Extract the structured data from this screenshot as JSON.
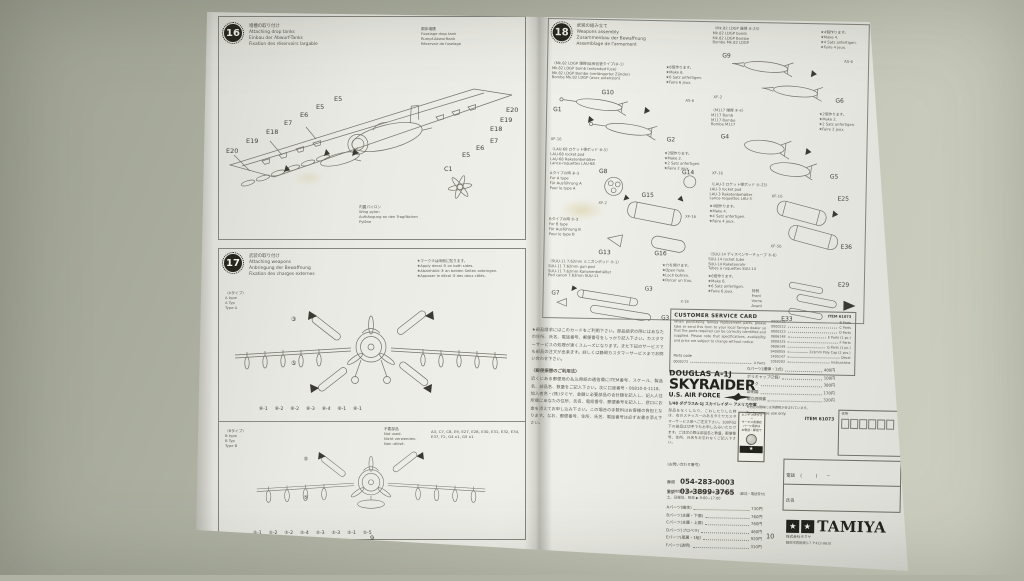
{
  "page9": {
    "page_number": "9",
    "step16": {
      "badge": "16",
      "title": [
        "増槽の取り付け",
        "Attaching drop tanks",
        "Einbau der Abwurf-Tanks",
        "Fixation des réservoirs largable"
      ],
      "fuselage_note": [
        "胴体増槽",
        "Fuselage drop tank",
        "Rumpf-Abwurftank",
        "Réservoir de fuselage"
      ],
      "pylon_note": [
        "内翼パイロン",
        "Wing pylon",
        "Aufhängung an den Tragflächen",
        "Pylône"
      ],
      "labels": {
        "l1": "E20",
        "l2": "E19",
        "l3": "E18",
        "l4": "E7",
        "l5": "E6",
        "l6": "E5",
        "l7": "E5",
        "c": "C1",
        "r1": "E5",
        "r2": "E6",
        "r3": "E7",
        "r4": "E18",
        "r5": "E19",
        "r6": "E20"
      }
    },
    "step17": {
      "badge": "17",
      "title": [
        "武装の取り付け",
        "Attaching weapons",
        "Anbringung der Bewaffnung",
        "Fixation des charges externes"
      ],
      "type_a": [
        "〈Aタイプ〉",
        "A type",
        "A Typ",
        "Type A"
      ],
      "decal_note": [
        "★マーク③は両側に貼ります。",
        "★Apply decal ③ on both sides.",
        "★Abziehbild ③ an beiden Seiten anbringen.",
        "★Apposer le décal ③ des deux côtés."
      ],
      "marks_a": {
        "m1": "③",
        "m2": "⑤"
      },
      "marks_b": {
        "m1": "⑤",
        "m2": "⑤"
      },
      "row_a": [
        "⑧-1",
        "⑧-2",
        "⑧-2",
        "⑧-3",
        "⑧-4",
        "⑧-1",
        "⑧-1"
      ],
      "type_b": [
        "〈Bタイプ〉",
        "B type",
        "B Typ",
        "Type B"
      ],
      "not_used": [
        "不要部品",
        "Not used.",
        "Nicht verwenden.",
        "Non utilisé."
      ],
      "not_used_parts": "A3, C7, C8, E9, E27, E28, E30, E31, E32, E34, E37, F2, G4 x1, G5 x1",
      "row_b": [
        "⑤-1",
        "⑤-2",
        "⑤-2",
        "⑤-4",
        "⑤-3",
        "⑤-3",
        "⑤-1",
        "⑤-5"
      ]
    }
  },
  "page10": {
    "page_number": "10",
    "step18": {
      "badge": "18",
      "title": [
        "武装の組み立て",
        "Weapons assembly",
        "Zusammenbau der Bewaffnung",
        "Assemblage de l'armement"
      ],
      "mk82ext": {
        "heading": [
          "〈Mk.82 LDGP 爆弾(延長信管タイプ)⑧-1〉",
          "Mk.82 LDGP bomb (extended fuse)",
          "Mk.82 LDGP Bombe (verlängerter Zünder)",
          "Bombe Mk.82 LDGP (avec extension)"
        ],
        "notes": [
          "★6個作ります。",
          "★Make 6.",
          "★6 Satz anfertigen.",
          "★Faire 6 jeux."
        ],
        "parts": {
          "a": "G10",
          "b": "G1",
          "c": "G2"
        },
        "paints": {
          "p1": "XF-16",
          "p2": "AS-6"
        }
      },
      "mk82": {
        "heading": [
          "〈Mk.82 LDGP 爆弾 ⑧-23〉",
          "Mk.82 LDGP bomb",
          "Mk.82 LDGP Bombe",
          "Bombe Mk.82 LDGP"
        ],
        "notes": [
          "★4個作ります。",
          "★Make 4.",
          "★4 Satz anfertigen.",
          "★Faire 4 jeux."
        ],
        "parts": {
          "a": "G9",
          "b": "G6"
        },
        "paints": {
          "p1": "AS-6",
          "p2": "XF-2"
        }
      },
      "m117": {
        "heading": [
          "〈M117 爆弾 ⑨-4〉",
          "M117 Bomb",
          "M117 Bombe",
          "Bombe M117"
        ],
        "notes": [
          "★2個作ります。",
          "★Make 2.",
          "★2 Satz anfertigen.",
          "★Faire 2 jeux."
        ],
        "parts": {
          "a": "G4",
          "b": "G5"
        },
        "paints": {
          "p1": "XF-16"
        }
      },
      "lau68": {
        "heading": [
          "〈LAU-68 ロケット弾ポッド ⑧-5〉",
          "LAU-68 rocket pod",
          "LAU-68 Raketenbehälter",
          "Lance-roquettes LAU-68"
        ],
        "notes": [
          "★2個作ります。",
          "★Make 2.",
          "★2 Satz anfertigen.",
          "★Faire 2 jeux."
        ],
        "type_a": [
          "Aタイプの時 ⑧-3",
          "For A type",
          "Für Ausführung A",
          "Pour le type A"
        ],
        "type_b": [
          "Bタイプの時 ⑤-3",
          "For B type",
          "Für Ausführung B",
          "Pour le type B"
        ],
        "parts": {
          "a": "G8",
          "b": "G15",
          "c": "G13",
          "d": "G16",
          "e": "G14"
        },
        "paints": {
          "p1": "XF-2",
          "p2": "XF-16"
        }
      },
      "lau3": {
        "heading": [
          "〈LAU-3 ロケット弾ポッド ⑤-23〉",
          "LAU-3 rocket pod",
          "LAU-3 Raketenbehälter",
          "Lance-roquettes LAU-3"
        ],
        "notes": [
          "★4個作ります。",
          "★Make 4.",
          "★4 Satz anfertigen.",
          "★Faire 4 jeux."
        ],
        "parts": {
          "a": "E25",
          "b": "E36"
        },
        "paints": {
          "p1": "XF-16",
          "p2": "XF-56"
        }
      },
      "suu11": {
        "heading": [
          "〈SUU-11 7.62mm ミニガンポッド ⑤-1〉",
          "SUU-11 7.62mm gun pod",
          "SUU-11 7.62mm Kanonenbehälter",
          "Pod canon 7.62mm SUU-11"
        ],
        "notes": [
          "★穴を開けます。",
          "★Open hole.",
          "★Loch bohren.",
          "★Percer un trou."
        ],
        "parts": {
          "a": "G7",
          "b": "G3",
          "c": "G3"
        },
        "paints": {
          "p1": "X-18"
        }
      },
      "suu14": {
        "heading": [
          "〈SUU-14 ディスペンサーチューブ ⑤-6〉",
          "SUU-14 rocket tube",
          "SUU-14 Raketenrohr",
          "Tubes à roquettes SUU-14"
        ],
        "notes": [
          "★6個作ります。",
          "★Make 6.",
          "★6 Satz anfertigen.",
          "★Faire 6 jeux."
        ],
        "front": [
          "前側",
          "Front",
          "Vorne",
          "Avant"
        ],
        "parts": {
          "a": "E29",
          "b": "E33"
        }
      }
    },
    "service_text": {
      "para1": "★部品請求にはこのカードをご利用下さい。部品請求の際にはあなたの住所、氏名、電話番号、郵便番号をしっかり記入下さい。カスタマーサービスの処理が速くスムーズになります。また下記のサービスでも部品の注文が出来ます。詳しくは静岡カスタマーサービスまでお問い合わせ下さい。",
      "heading2": "〈郵便振替のご利用法〉",
      "para2": "近くにある郵便局の払込用紙の通信欄にITEM番号、スケール、製品名、部品名、数量をご記入下さい。次に口座番号・00810-0-1118、加入者名・(株)タミヤ、金額に必要部品の合計額を記入し、記入人住所欄にあなたの住所、氏名、電話番号、郵便番号を記入し、窓口にお金を添えてお申し込み下さい。この場合の手数料はお客様の負担となります。なお、郵便番号、住所、氏名、電話番号は必ずお書き添え下さい。"
    },
    "customer_card": {
      "title": "CUSTOMER SERVICE CARD",
      "body": "When purchasing Tamiya replacement parts, please take or send this form to your local Tamiya dealer so that the parts required can be correctly identified and supplied. Please note that specifications, availability and price are subject to change without notice.",
      "parts_code_label": "Parts code",
      "first_code": "0000273",
      "first_label": "A Parts",
      "item": "ITEM 61073",
      "codes": [
        {
          "c": "0000221",
          "l": "B Parts"
        },
        {
          "c": "0000222",
          "l": "C Parts"
        },
        {
          "c": "0000223",
          "l": "D Parts"
        },
        {
          "c": "0606148",
          "l": "E Parts (1 pc.)"
        },
        {
          "c": "0000225",
          "l": "F Parts"
        },
        {
          "c": "0606149",
          "l": "G Parts (1 pc.)"
        },
        {
          "c": "9400055",
          "l": "2x3mm Poly Cap (2 pcs.)"
        },
        {
          "c": "1405147",
          "l": "Decal"
        },
        {
          "c": "1050203",
          "l": "Instructions"
        }
      ]
    },
    "product": {
      "name1": "DOUGLAS A-1J",
      "name2": "SKYRAIDER",
      "name3": "U.S. AIR FORCE",
      "sub": "1/48 ダグラスA-1J スカイレイダー アメリカ空軍",
      "body": "部品をなくしたり、こわしたりした時は、右のステッカーのあるタミヤカスタマーサービス係へご注文下さい。100円以下の部品は切手でもお申し込みいただけます。ご注文の際は部品名と数量、郵便番号、住所、氏名をお忘れなくご記入下さい。",
      "inquiry": "(お問い合わせ番号)",
      "badge": [
        "タミヤ カスタマー",
        "サービス直通店",
        "パーツ請求は",
        "お電話・郵送で"
      ],
      "phone1_label": "静岡",
      "phone1": "054-283-0003",
      "phone2_label": "東京",
      "phone2": "03-3899-3765",
      "phone2_note": "(郵送・電話受付)",
      "hours1": "受付時間/平日(月~金曜日)▶ 9:00~12:00",
      "hours2": "土、日曜日、祝日 ▶ 9:00~17:00",
      "prices_left": [
        {
          "l": "Aパーツ(機体)",
          "v": "730円"
        },
        {
          "l": "Bパーツ(主翼・下面)",
          "v": "760円"
        },
        {
          "l": "Cパーツ(主翼・上面)",
          "v": "760円"
        },
        {
          "l": "Dパーツ(プロペラ)",
          "v": "460円"
        },
        {
          "l": "Eパーツ(尾翼・1組)",
          "v": "920円"
        },
        {
          "l": "Fパーツ(透明)",
          "v": "310円"
        }
      ],
      "prices_right": [
        {
          "l": "Gパーツ(爆弾・1式)",
          "v": "400円"
        },
        {
          "l": "ポリキャップ(2個)",
          "v": "100円"
        },
        {
          "l": "マーク",
          "v": "380円"
        },
        {
          "l": "説明図",
          "v": "170円"
        },
        {
          "l": "組立説明書",
          "v": "320円"
        }
      ],
      "note_right": "★上記の価格には消費税が含まれています。",
      "for_japan": "For Japanese use only.",
      "item_right": "ITEM 61073",
      "form": {
        "address_label": "住所",
        "phone_label": "電話",
        "phone_value": "(　　　)　　－",
        "name_label": "氏名"
      }
    },
    "tamiya": {
      "logo": "TAMIYA",
      "company": "株式会社タミヤ",
      "address": "静岡市恩田原3-7 〒422-8610"
    }
  }
}
